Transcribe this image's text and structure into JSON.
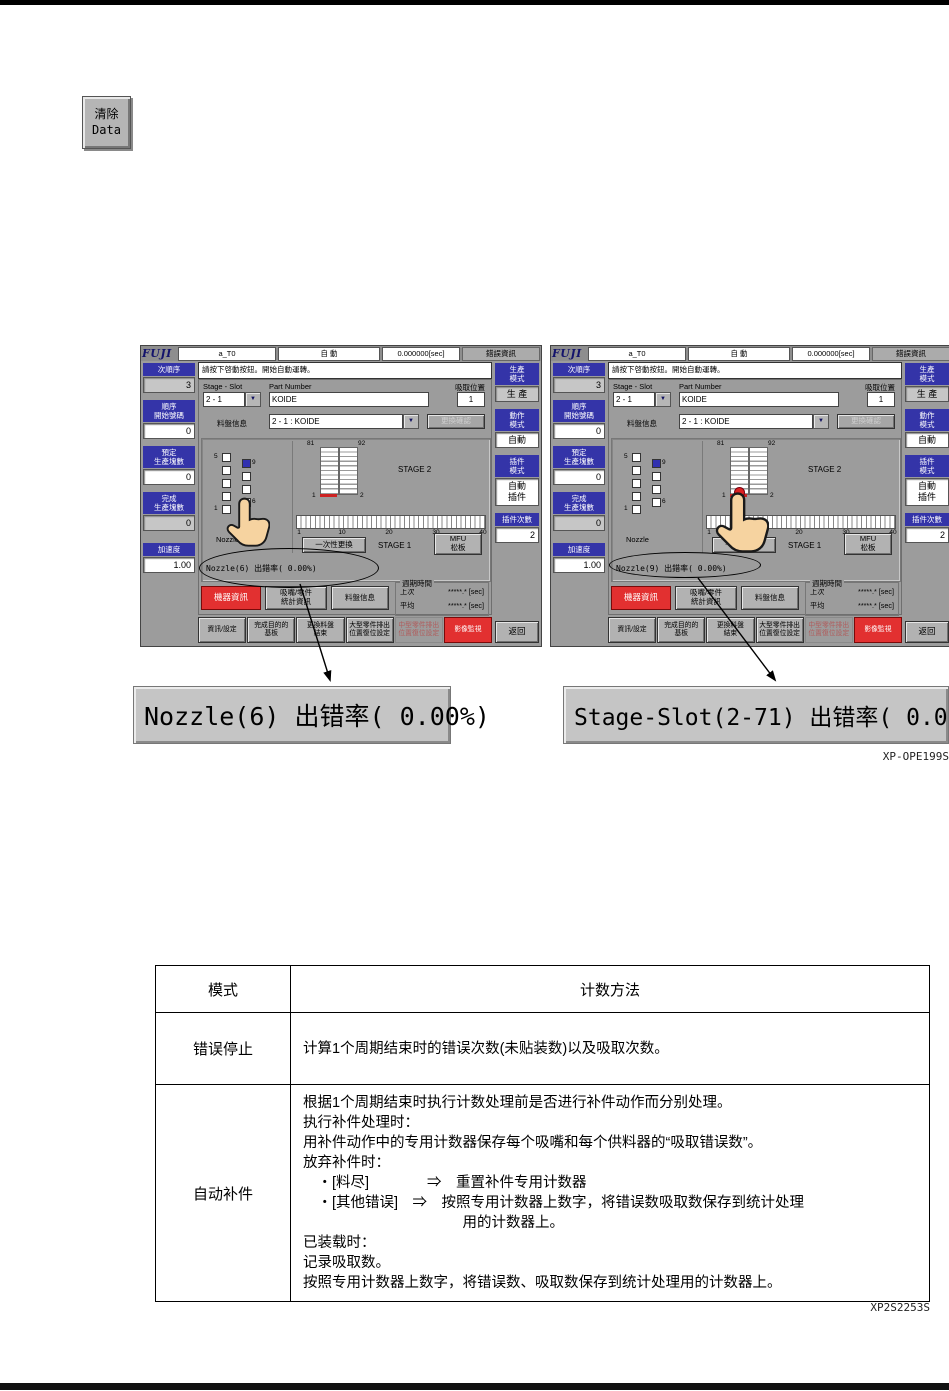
{
  "page": {
    "clear_button": {
      "line1": "清除",
      "line2": "Data"
    },
    "figure_code_1": "XP-OPE199S",
    "figure_code_2": "XP2S2253S"
  },
  "colors": {
    "sidebar_blue": "#3434a8",
    "alert_red": "#e23030",
    "slot_red": "#cc2222",
    "panel_gray": "#9c9c9c"
  },
  "machine": {
    "top": {
      "logo": "FUJI",
      "job": "a_T0",
      "mode": "自 動",
      "time": "0.000000[sec]",
      "error_info": "錯誤資訊"
    },
    "message": "請按下啓動按鈕。開始自動運轉。",
    "sidebar_left": {
      "seq_label": "次順序",
      "seq_value": "3",
      "start_label": "順序\n開始號碼",
      "start_value": "0",
      "planned_label": "預定\n生產塊數",
      "planned_value": "0",
      "finished_label": "完成\n生產塊數",
      "finished_value": "0",
      "accel_label": "加速度",
      "accel_value": "1.00"
    },
    "sidebar_right": {
      "prod_label": "生產\n模式",
      "prod_value": "生 產",
      "action_label": "動作\n模式",
      "action_value": "自動",
      "insert_label": "插件\n模式",
      "insert_value": "自動\n插件",
      "count_label": "插件次數",
      "count_value": "2",
      "back": "返回"
    },
    "form": {
      "stage_slot_label": "Stage - Slot",
      "stage_slot_value": "2 - 1",
      "part_number_label": "Part Number",
      "part_number_value": "KOIDE",
      "pickup_label": "吸取位置",
      "pickup_value": "1",
      "tray_label": "料盤信息",
      "tray_value": "2 - 1 : KOIDE",
      "confirm_button": "更換確認",
      "dropdown_caret": "▼"
    },
    "stage": {
      "n5": "5",
      "n1": "1",
      "n9": "9",
      "n6": "6",
      "nozzle_label": "Nozzle",
      "s81": "81",
      "s92": "92",
      "s1": "1",
      "s2": "2",
      "stage2_label": "STAGE 2",
      "stage1_label": "STAGE 1",
      "ticks": [
        "1",
        "10",
        "20",
        "30",
        "40"
      ],
      "exchange_button": "一次性更換",
      "mfu_button": "MFU\n松板"
    },
    "mid": {
      "machine_info_button": "機器資訊",
      "stats_button": "吸嘴/零件\n統計資訊",
      "tray_info_button": "料盤信息",
      "cycle_label": "週期時間",
      "last_label": "上次",
      "last_value": "*****.* [sec]",
      "avg_label": "平均",
      "avg_value": "*****.* [sec]"
    },
    "bottom": {
      "b1": "資訊/設定",
      "b2": "完成目的的\n基板",
      "b3": "更換料盤\n結束",
      "b4": "大型零件排出\n位置復位設定",
      "b5": "中型零件排出\n位置復位設定",
      "b6": "影像監視"
    }
  },
  "screens": {
    "left": {
      "status": "Nozzle(6) 出錯率( 0.00%)"
    },
    "right": {
      "status": "Nozzle(9) 出錯率( 0.00%)"
    }
  },
  "callouts": {
    "left": "Nozzle(6) 出错率( 0.00%)",
    "right": "Stage-Slot(2-71) 出错率( 0.00%)"
  },
  "table": {
    "headers": [
      "模式",
      "计数方法"
    ],
    "rows": [
      {
        "mode": "错误停止",
        "desc": [
          "计算1个周期结束时的错误次数(未贴装数)以及吸取次数。"
        ]
      },
      {
        "mode": "自动补件",
        "desc": [
          "根据1个周期结束时执行计数处理前是否进行补件动作而分别处理。",
          "执行补件处理时：",
          "用补件动作中的专用计数器保存每个吸嘴和每个供料器的“吸取错误数”。",
          "放弃补件时：",
          "　・[料尽]　　　　⇒　重置补件专用计数器",
          "　・[其他错误]　⇒　按照专用计数器上数字，将错误数吸取数保存到统计处理",
          "　　　　　　　　　　　用的计数器上。",
          "已装载时：",
          "记录吸取数。",
          "按照专用计数器上数字，将错误数、吸取数保存到统计处理用的计数器上。"
        ]
      }
    ]
  }
}
